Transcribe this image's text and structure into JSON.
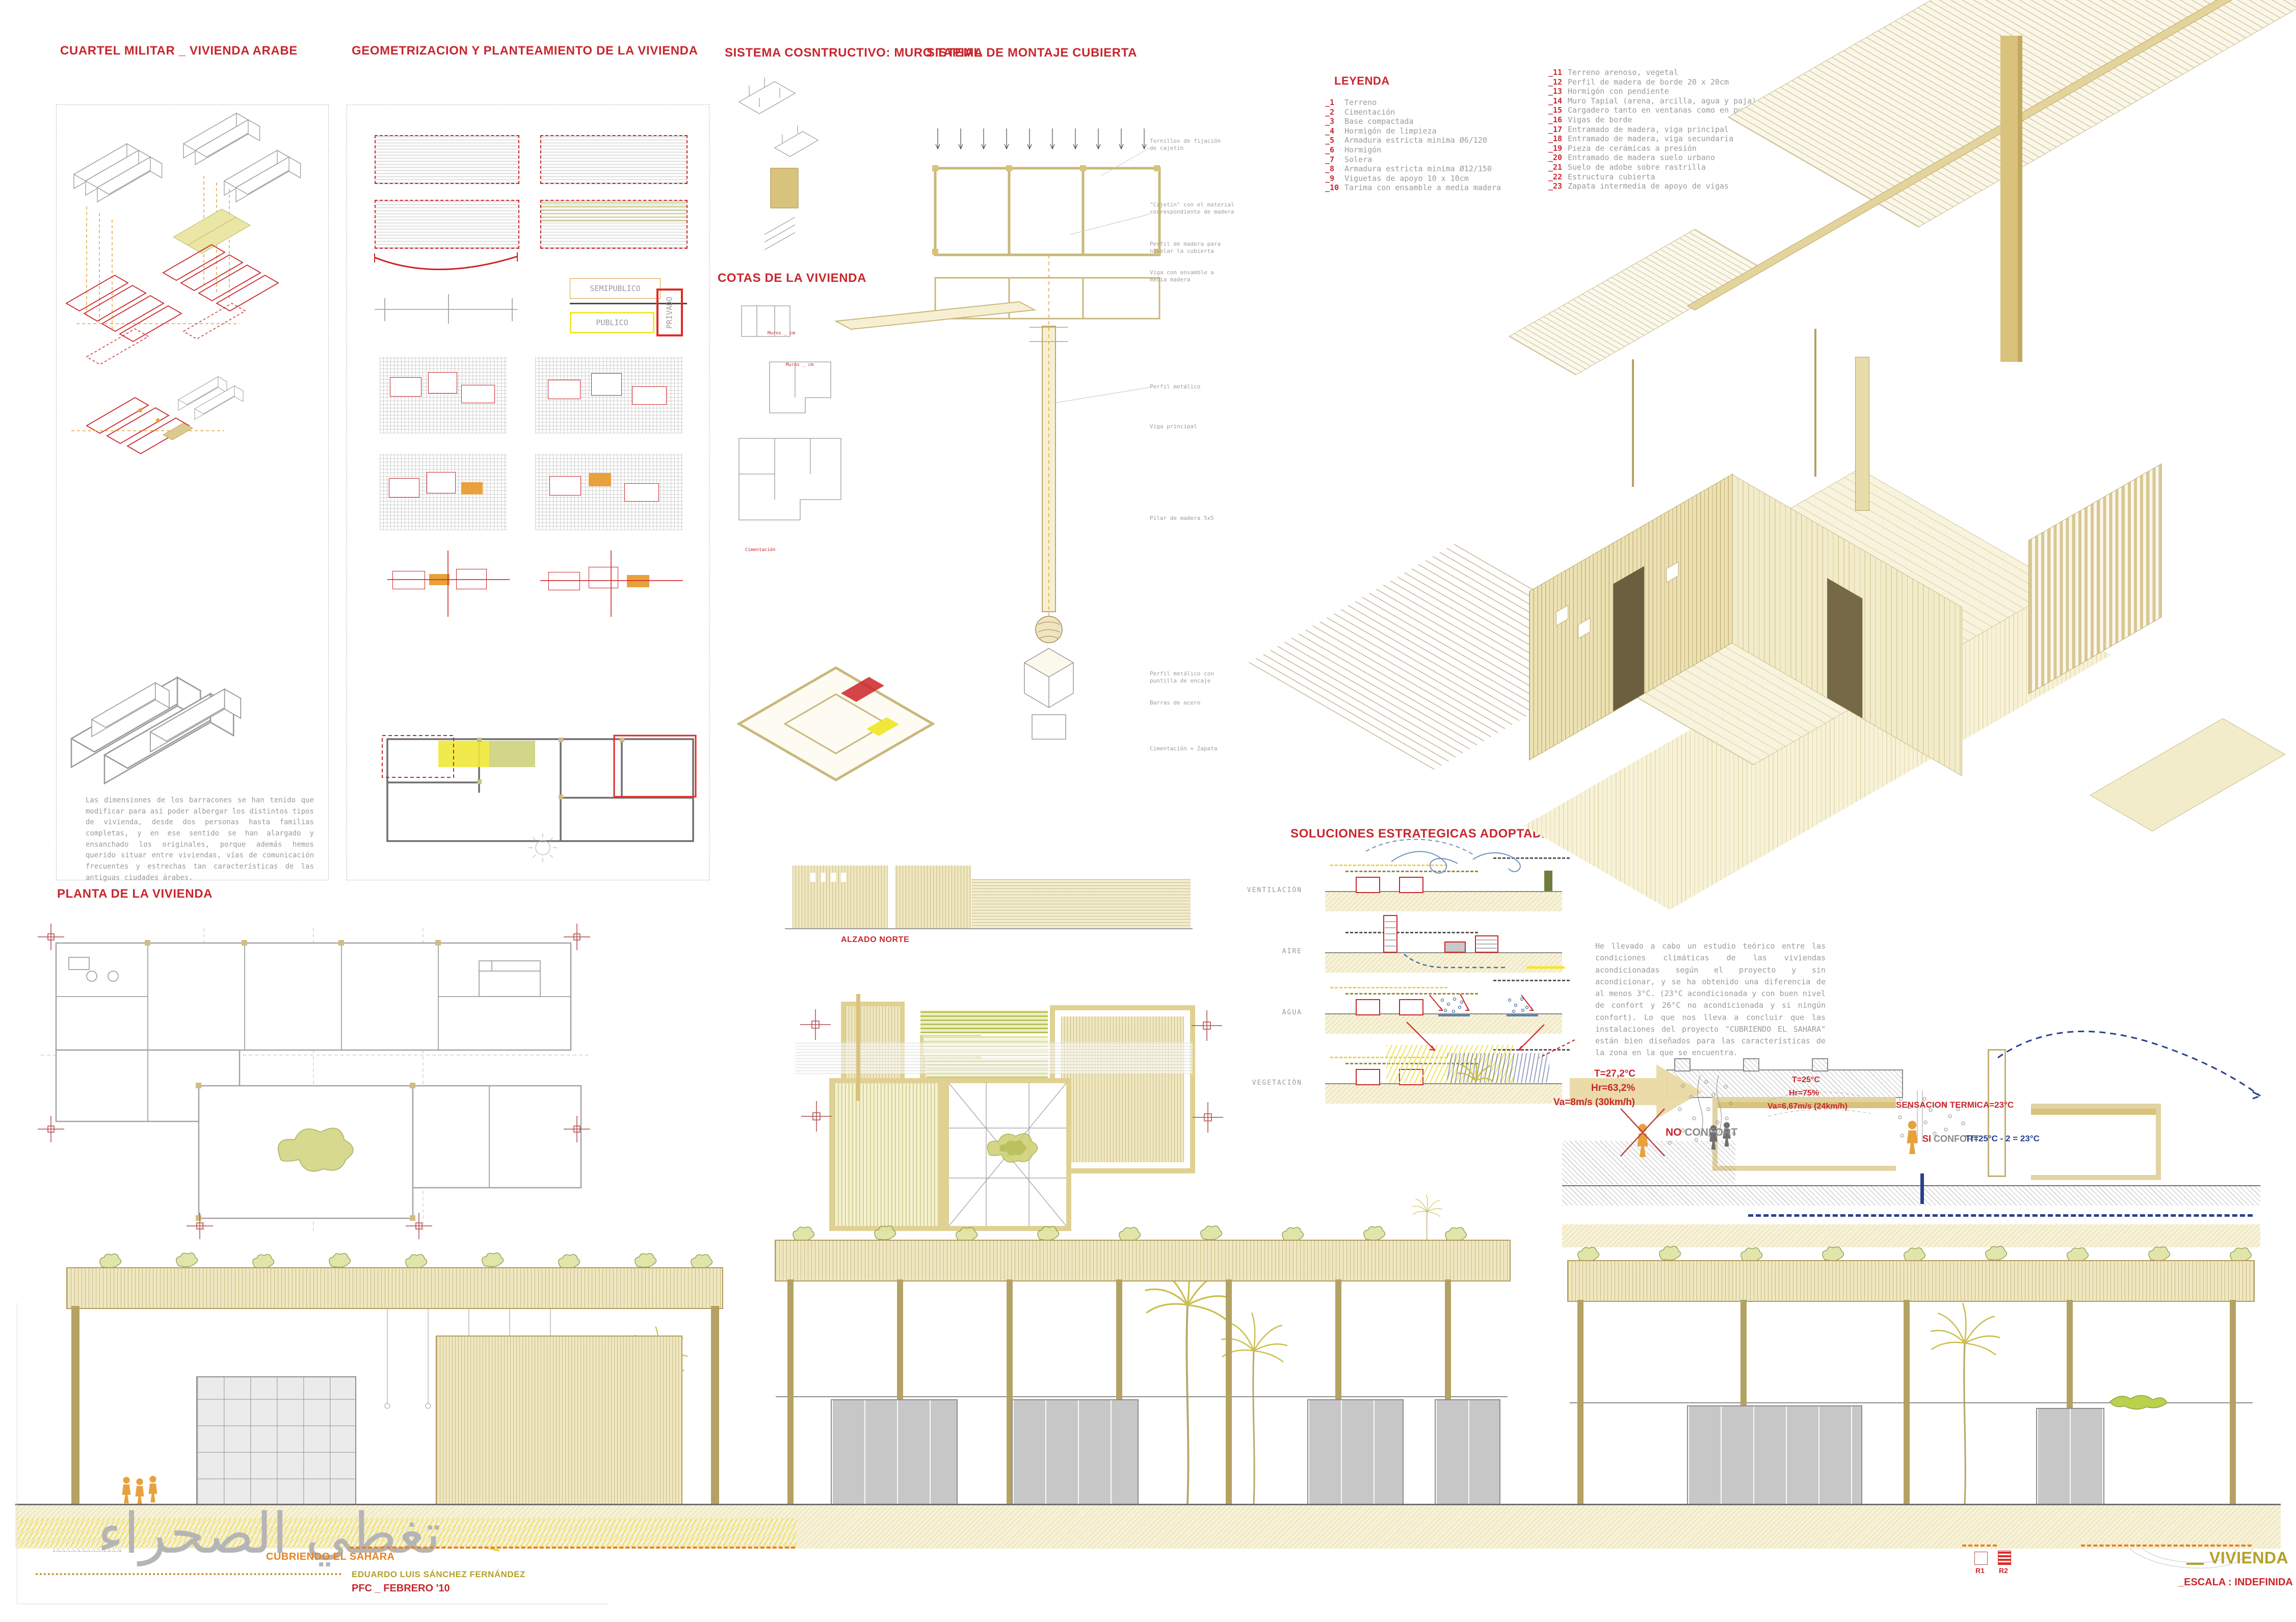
{
  "titles": {
    "cuartel": "CUARTEL MILITAR _ VIVIENDA ARABE",
    "geometrizacion": "GEOMETRIZACION Y PLANTEAMIENTO DE LA VIVIENDA",
    "sistema_constructivo": "SISTEMA COSNTRUCTIVO: MURO TAPIAL",
    "montaje_cubierta": "SISTEMA DE MONTAJE CUBIERTA",
    "cotas": "COTAS DE LA VIVIENDA",
    "planta_vivienda": "PLANTA DE LA VIVIENDA",
    "soluciones": "SOLUCIONES ESTRATEGICAS ADOPTADAS AL PROYECTO",
    "alzado_norte": "ALZADO NORTE",
    "planta_cubierta": "PLANTA DE CUBIERTA"
  },
  "cuartel": {
    "paragraph": "Las dimensiones de los barracones se han tenido que modificar para así poder albergar los distintos tipos de vivienda, desde dos personas hasta familias completas, y en ese sentido se han alargado y ensanchado los originales, porque además hemos querido situar entre viviendas, vías de comunicación frecuentes y estrechas tan características de las antiguas ciudades árabes."
  },
  "geometrizacion": {
    "zones": {
      "semipublico": "SEMIPUBLICO",
      "publico": "PUBLICO",
      "privado": "PRIVADO"
    }
  },
  "cotas": {
    "labels": [
      "Muros _ cm",
      "Muros _ cm",
      "Cimentación"
    ]
  },
  "montaje": {
    "annotations": [
      "Tornillos de fijación de cajetín",
      "\"Cajetín\" con el material correspondiente de madera",
      "Perfil de madera para nivelar la cubierta",
      "Viga con ensamble a media madera",
      "Perfil metálico",
      "Viga principal",
      "Pilar de madera 5x5",
      "Perfil metálico con puntilla de encaje",
      "Barras de acero",
      "Cimentación + Zapata"
    ]
  },
  "leyenda": {
    "title": "LEYENDA",
    "col1": [
      {
        "n": "_1",
        "t": "Terreno"
      },
      {
        "n": "_2",
        "t": "Cimentación"
      },
      {
        "n": "_3",
        "t": "Base compactada"
      },
      {
        "n": "_4",
        "t": "Hormigón de limpieza"
      },
      {
        "n": "_5",
        "t": "Armadura estricta minima Ø6/120"
      },
      {
        "n": "_6",
        "t": "Hormigón"
      },
      {
        "n": "_7",
        "t": "Solera"
      },
      {
        "n": "_8",
        "t": "Armadura estricta minima Ø12/150"
      },
      {
        "n": "_9",
        "t": "Viguetas de apoyo 10 x 10cm"
      },
      {
        "n": "_10",
        "t": "Tarima con ensamble a media madera"
      }
    ],
    "col2": [
      {
        "n": "_11",
        "t": "Terreno arenoso, vegetal"
      },
      {
        "n": "_12",
        "t": "Perfil de madera de borde 20 x 20cm"
      },
      {
        "n": "_13",
        "t": "Hormigón con pendiente"
      },
      {
        "n": "_14",
        "t": "Muro Tapial (arena, arcilla, agua y paja)"
      },
      {
        "n": "_15",
        "t": "Cargadero tanto en ventanas como en puertas"
      },
      {
        "n": "_16",
        "t": "Vigas de borde"
      },
      {
        "n": "_17",
        "t": "Entramado de madera, viga principal"
      },
      {
        "n": "_18",
        "t": "Entramado de madera, viga secundaria"
      },
      {
        "n": "_19",
        "t": "Pieza de cerámicas a presión"
      },
      {
        "n": "_20",
        "t": "Entramado de madera suelo urbano"
      },
      {
        "n": "_21",
        "t": "Suelo de adobe sobre rastrilla"
      },
      {
        "n": "_22",
        "t": "Estructura cubierta"
      },
      {
        "n": "_23",
        "t": "Zapata intermedia de apoyo de vigas"
      }
    ]
  },
  "soluciones": {
    "rows": [
      "VENTILACIÓN",
      "AIRE",
      "AGUA",
      "VEGETACIÓN"
    ],
    "paragraph": "He llevado a cabo un estudio teórico entre las condiciones climáticas de las viviendas acondicionadas según el proyecto y sin acondicionar, y se ha obtenido una diferencia de al menos 3°C. (23°C acondicionada y con buen nivel de confort y 26°C no acondicionada y si ningún confort). Lo que nos lleva a concluir que las instalaciones del proyecto \"CUBRIENDO EL SAHARA\" están bien diseñados para las características de la zona en la que se encuentra."
  },
  "confort": {
    "no_t": "T=27,2°C",
    "no_hr": "Hr=63,2%",
    "no_va": "Va=8m/s (30km/h)",
    "no_label": "NO",
    "no_label2": "CONFORT",
    "si_t": "T=25°C",
    "si_hr": "Hr=75%",
    "si_va": "Va=6,67m/s (24km/h)",
    "sensacion": "SENSACION TERMICA=23°C",
    "si_label": "SI",
    "si_label2": "CONFORT",
    "formula": "Tf=25°C - 2 = 23°C"
  },
  "titleblock": {
    "arabic": "تغطي الصحراء",
    "subtitle": "CUBRIENDO EL SAHARA",
    "author": "EDUARDO LUIS SÁNCHEZ FERNÁNDEZ",
    "pfc": "PFC _ FEBRERO '10",
    "sheet": "VIVIENDA",
    "scale": "_ESCALA : INDEFINIDA",
    "r1": "R1",
    "r2": "R2"
  },
  "colors": {
    "accent_red": "#c8262c",
    "accent_orange": "#e8821e",
    "accent_olive": "#b3a02a",
    "sand": "#f3ecca",
    "navy": "#2a3f8f",
    "yellow": "#f0e838"
  }
}
